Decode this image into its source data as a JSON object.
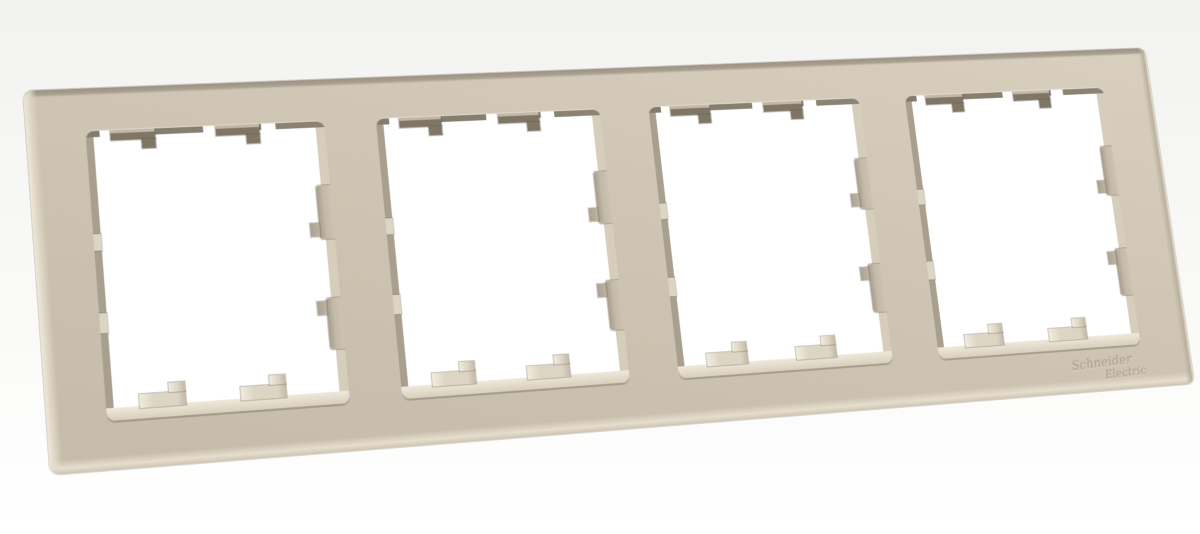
{
  "image": {
    "type": "product-photo",
    "subject": "4-gang wall switch/socket surround frame, angled view",
    "finish": "sand beige plastic"
  },
  "brand": {
    "logo_line1": "Schneider",
    "logo_line2": "Electric"
  },
  "windows": {
    "count": 4
  },
  "colors": {
    "background_top": "#f2f2f0",
    "background_mid": "#f8f8f6",
    "background_bottom": "#ffffff",
    "frame_face": "#cfc5b4",
    "frame_face_light": "#d9cfbf",
    "frame_face_dark": "#c5bbaa",
    "bevel_top": "#9c9283",
    "bevel_left": "#efe8da",
    "bevel_bottom": "#e6decd",
    "bevel_right": "#b9af9d",
    "wall_top": "#8c8374",
    "wall_left": "#a99f8e",
    "wall_right": "#d6cdbb",
    "wall_bottom": "#d8cfbc",
    "wall_bottom_light": "#efe8da",
    "tab_dark": "#7f7666",
    "tab_dark_hi": "#c2b8a7",
    "tab_light": "#ddd5c3",
    "tab_light_hi": "#f2ecdf",
    "tab_side": "#c3b9a8",
    "hole_white": "#ffffff",
    "logo_text": "#ab9f8c"
  }
}
